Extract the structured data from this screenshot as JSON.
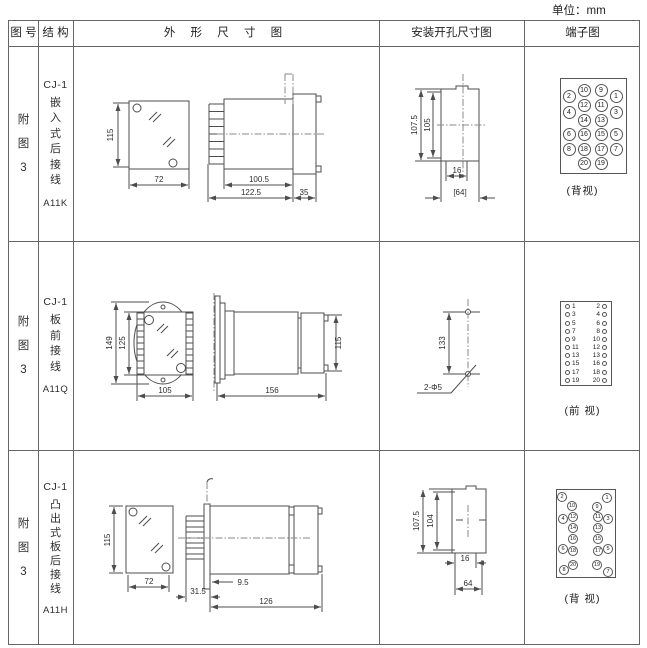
{
  "unit_label": "单位：mm",
  "header": {
    "fig": "图 号",
    "struct": "结 构",
    "outline": "外 形 尺 寸 图",
    "install": "安装开孔尺寸图",
    "terminal": "端子图"
  },
  "rows": [
    {
      "fig": [
        "附",
        "图",
        "3"
      ],
      "struct_top": "CJ-1",
      "struct_chars": [
        "嵌",
        "入",
        "式",
        "后",
        "接",
        "线"
      ],
      "model": "A11K",
      "dims": {
        "front_h": "115",
        "front_w": "72",
        "side_a": "100.5",
        "side_b": "122.5",
        "side_c": "35",
        "inst_v1": "107.5",
        "inst_v2": "105",
        "inst_w1": "16",
        "inst_w2": "[64]"
      },
      "caption": "(背视)",
      "terminals": [
        {
          "n": "10",
          "x": 60,
          "y": 44
        },
        {
          "n": "9",
          "x": 77,
          "y": 44
        },
        {
          "n": "2",
          "x": 45,
          "y": 50
        },
        {
          "n": "1",
          "x": 92,
          "y": 50
        },
        {
          "n": "12",
          "x": 60,
          "y": 59
        },
        {
          "n": "11",
          "x": 77,
          "y": 59
        },
        {
          "n": "4",
          "x": 45,
          "y": 66
        },
        {
          "n": "3",
          "x": 92,
          "y": 66
        },
        {
          "n": "14",
          "x": 60,
          "y": 74
        },
        {
          "n": "13",
          "x": 77,
          "y": 74
        },
        {
          "n": "6",
          "x": 45,
          "y": 88
        },
        {
          "n": "16",
          "x": 60,
          "y": 88
        },
        {
          "n": "15",
          "x": 77,
          "y": 88
        },
        {
          "n": "5",
          "x": 92,
          "y": 88
        },
        {
          "n": "8",
          "x": 45,
          "y": 103
        },
        {
          "n": "18",
          "x": 60,
          "y": 103
        },
        {
          "n": "17",
          "x": 77,
          "y": 103
        },
        {
          "n": "7",
          "x": 92,
          "y": 103
        },
        {
          "n": "20",
          "x": 60,
          "y": 117
        },
        {
          "n": "19",
          "x": 77,
          "y": 117
        }
      ]
    },
    {
      "fig": [
        "附",
        "图",
        "3"
      ],
      "struct_top": "CJ-1",
      "struct_chars": [
        "板",
        "前",
        "接",
        "线"
      ],
      "model": "A11Q",
      "dims": {
        "front_v1": "149",
        "front_v2": "125",
        "front_w": "105",
        "side_h": "115",
        "side_w": "156",
        "inst_v": "133",
        "leader": "2-Φ5"
      },
      "caption": "(前 视)",
      "terminal_rows": [
        [
          "1",
          "2"
        ],
        [
          "3",
          "4"
        ],
        [
          "5",
          "6"
        ],
        [
          "7",
          "8"
        ],
        [
          "9",
          "10"
        ],
        [
          "11",
          "12"
        ],
        [
          "13",
          "13"
        ],
        [
          "15",
          "16"
        ],
        [
          "17",
          "18"
        ],
        [
          "19",
          "20"
        ]
      ]
    },
    {
      "fig": [
        "附",
        "图",
        "3"
      ],
      "struct_top": "CJ-1",
      "struct_chars": [
        "凸",
        "出",
        "式",
        "板",
        "后",
        "接",
        "线"
      ],
      "model": "A11H",
      "dims": {
        "front_h": "115",
        "front_w": "72",
        "side_a": "9.5",
        "side_b": "31.5",
        "side_c": "126",
        "inst_v1": "107.5",
        "inst_v2": "104",
        "inst_w1": "16",
        "inst_w2": "64"
      },
      "caption": "(背 视)",
      "terminals": [
        {
          "n": "2",
          "x": 38,
          "y": 47
        },
        {
          "n": "1",
          "x": 83,
          "y": 48
        },
        {
          "n": "10",
          "x": 48,
          "y": 56
        },
        {
          "n": "9",
          "x": 73,
          "y": 57
        },
        {
          "n": "4",
          "x": 39,
          "y": 69
        },
        {
          "n": "12",
          "x": 49,
          "y": 67
        },
        {
          "n": "11",
          "x": 74,
          "y": 67
        },
        {
          "n": "3",
          "x": 84,
          "y": 69
        },
        {
          "n": "14",
          "x": 49,
          "y": 78
        },
        {
          "n": "13",
          "x": 74,
          "y": 78
        },
        {
          "n": "16",
          "x": 49,
          "y": 89
        },
        {
          "n": "15",
          "x": 74,
          "y": 89
        },
        {
          "n": "6",
          "x": 39,
          "y": 99
        },
        {
          "n": "18",
          "x": 49,
          "y": 101
        },
        {
          "n": "17",
          "x": 74,
          "y": 101
        },
        {
          "n": "5",
          "x": 84,
          "y": 99
        },
        {
          "n": "20",
          "x": 49,
          "y": 115
        },
        {
          "n": "19",
          "x": 73,
          "y": 115
        },
        {
          "n": "8",
          "x": 40,
          "y": 120
        },
        {
          "n": "7",
          "x": 84,
          "y": 122
        }
      ]
    }
  ]
}
